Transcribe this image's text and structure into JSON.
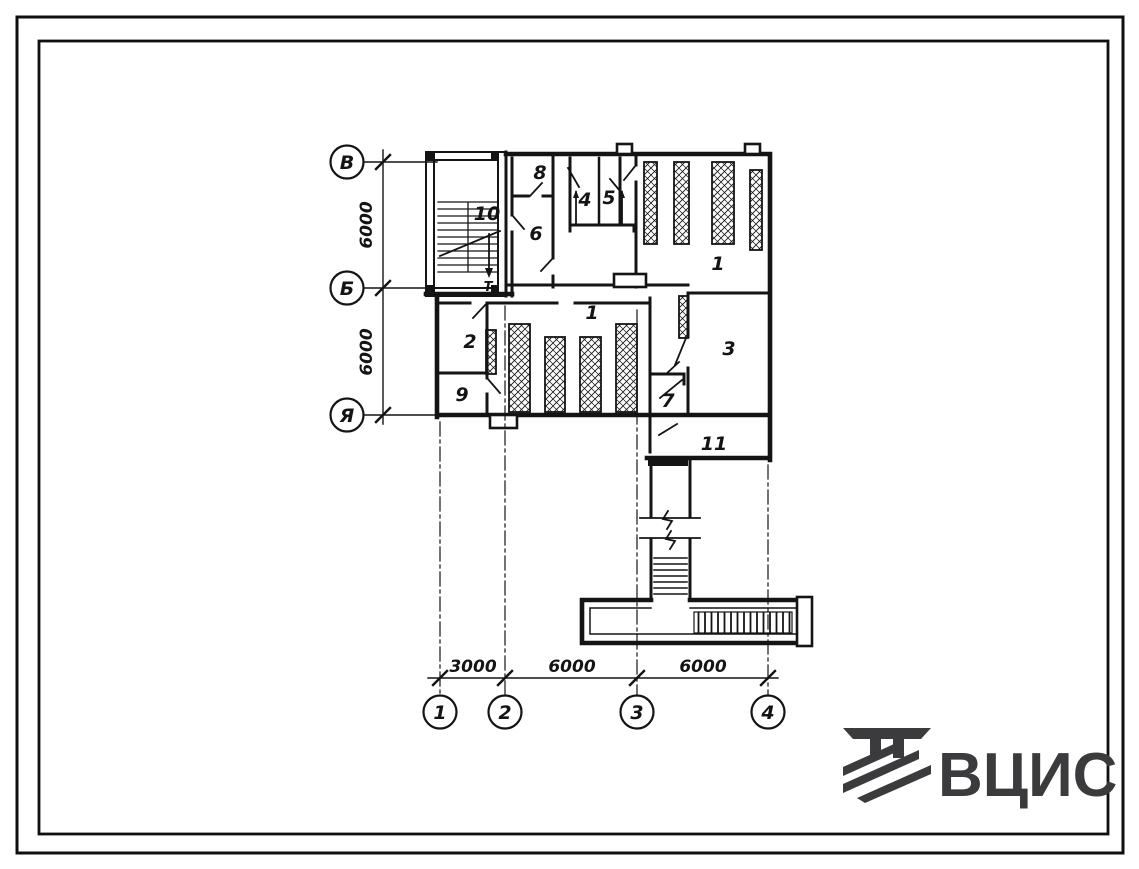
{
  "page": {
    "background": "#ffffff",
    "ink": "#141414",
    "frame_color": "#0f0f0f"
  },
  "plan": {
    "room_labels": [
      {
        "id": "room-1-upper",
        "text": "1"
      },
      {
        "id": "room-1-lower",
        "text": "1"
      },
      {
        "id": "room-2",
        "text": "2"
      },
      {
        "id": "room-3",
        "text": "3"
      },
      {
        "id": "room-4",
        "text": "4"
      },
      {
        "id": "room-5",
        "text": "5"
      },
      {
        "id": "room-6",
        "text": "6"
      },
      {
        "id": "room-7",
        "text": "7"
      },
      {
        "id": "room-8",
        "text": "8"
      },
      {
        "id": "room-9",
        "text": "9"
      },
      {
        "id": "room-10",
        "text": "10"
      },
      {
        "id": "room-11",
        "text": "11"
      }
    ],
    "row_axes": [
      {
        "label": "В"
      },
      {
        "label": "Б"
      },
      {
        "label": "Я"
      }
    ],
    "col_axes": [
      {
        "label": "1"
      },
      {
        "label": "2"
      },
      {
        "label": "3"
      },
      {
        "label": "4"
      }
    ],
    "dims_left": [
      {
        "value": "6000"
      },
      {
        "value": "6000"
      }
    ],
    "dims_bottom": [
      {
        "value": "3000"
      },
      {
        "value": "6000"
      },
      {
        "value": "6000"
      }
    ],
    "stair_mark": "Т"
  },
  "logo": {
    "text": "ВЦИС",
    "color": "#3b3b3d"
  }
}
